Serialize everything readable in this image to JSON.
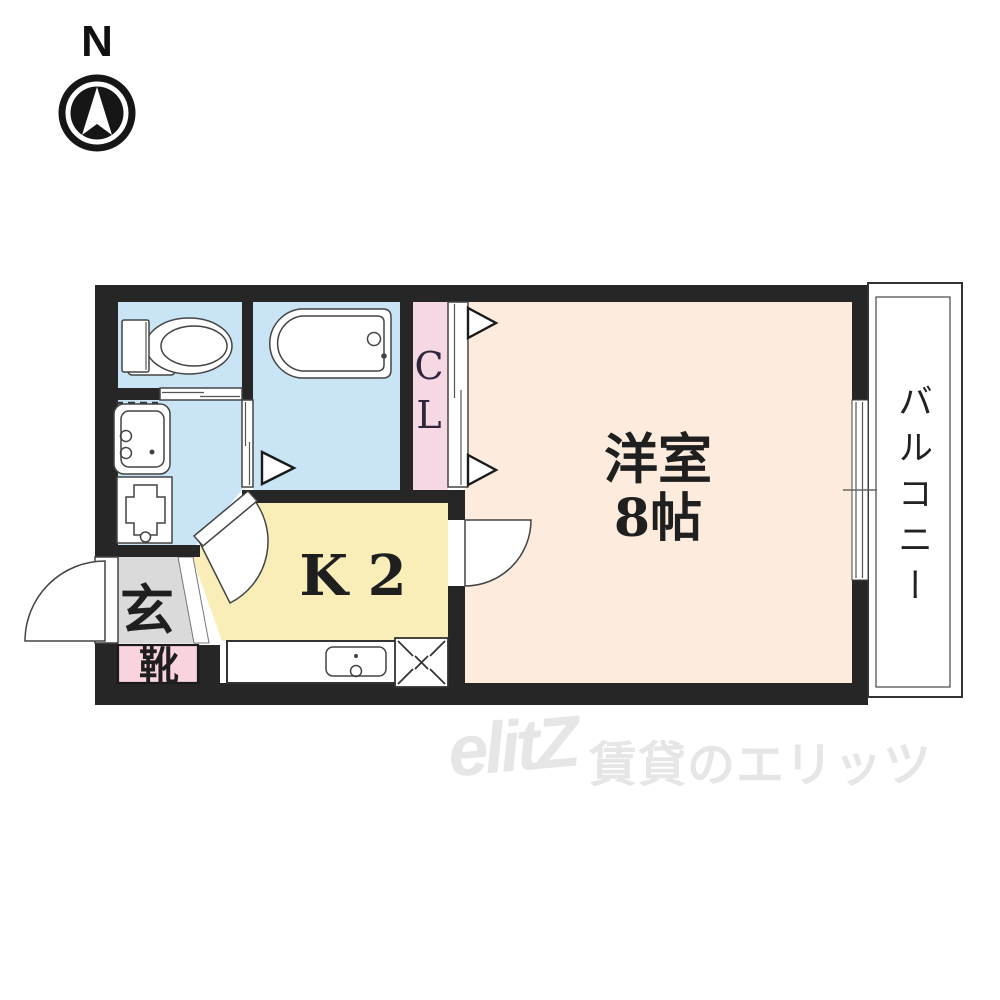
{
  "compass": {
    "label": "N"
  },
  "plan": {
    "western_room": {
      "line1": "洋室",
      "line2": "8帖"
    },
    "kitchen_label": "K 2",
    "closet_label": "CL",
    "balcony_label": "バルコニー",
    "entrance_label": "玄",
    "shoe_label": "靴"
  },
  "watermark": {
    "logo": "elitZ",
    "text": "賃貸のエリッツ"
  },
  "colors": {
    "wall": "#262626",
    "water_blue": "#c9e4f5",
    "room_peach": "#fdecde",
    "kitchen_yellow": "#f9eeb8",
    "closet_pink": "#f5d8e4",
    "shoe_pink": "#f9d3de",
    "entrance_gray": "#dadada",
    "white": "#ffffff",
    "compass_black": "#161616",
    "text": "#1f1f1f",
    "watermark_gray": "#e6e6e6"
  }
}
